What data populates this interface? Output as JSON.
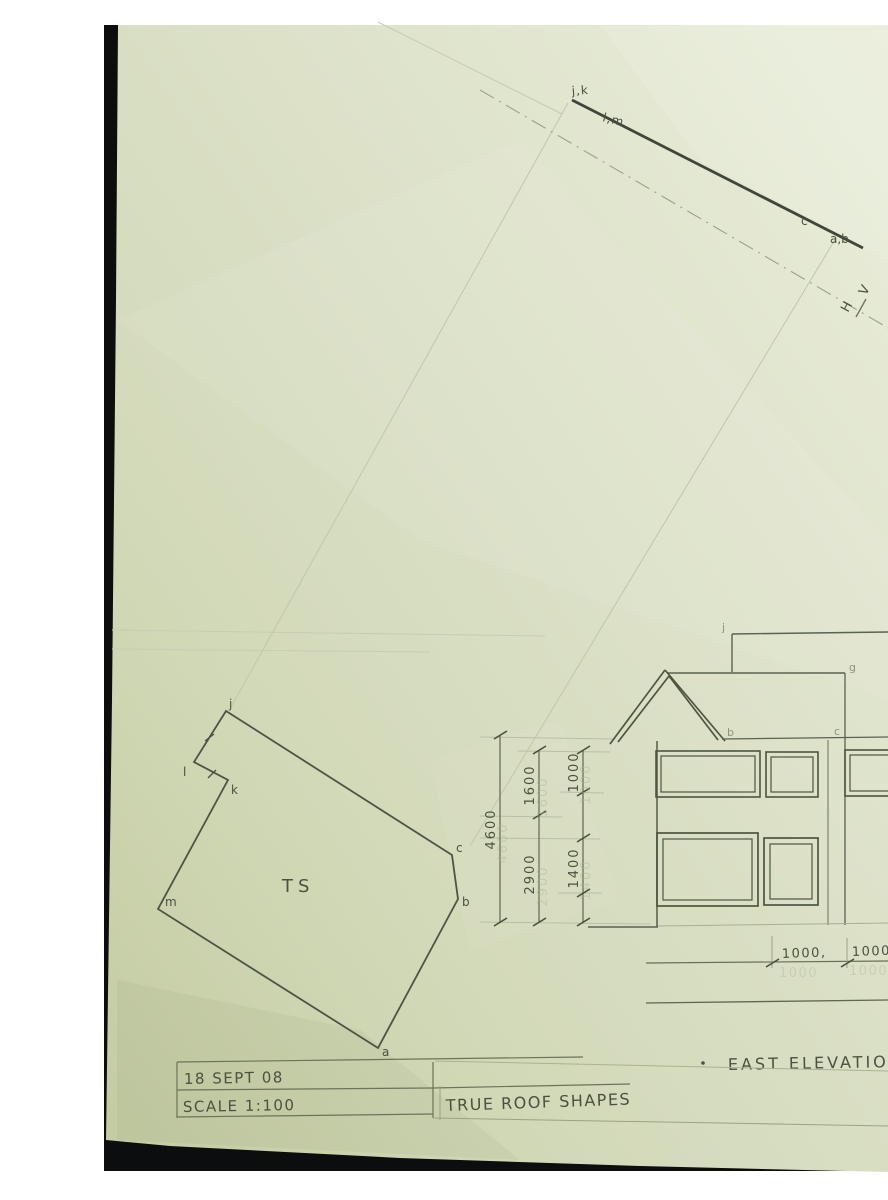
{
  "edge_view": {
    "end_top_label": "j,k",
    "mid_label": "l,m",
    "point_c_label": "c",
    "end_bottom_label": "a,b",
    "v_label": "V",
    "h_label": "H"
  },
  "true_shape": {
    "shape_label": "TS",
    "vertex_top": "j",
    "vertex_notch_left": "l",
    "vertex_notch_inner": "k",
    "vertex_left": "m",
    "vertex_bottom": "a",
    "vertex_right": "b",
    "vertex_upper_right": "c"
  },
  "dimensions": {
    "overall_height": "4600",
    "upper_segment": "1600",
    "lower_segment": "2900",
    "window_top_segment": "1000",
    "window_mid_segment": "1400",
    "spacing_first": "1000,",
    "spacing_second": "1000"
  },
  "elevation": {
    "title": "EAST ELEVATION",
    "ridge_label": "j",
    "corner_label": "g",
    "eave_right_label": "b",
    "eave_far_label": "c"
  },
  "title_block": {
    "date": "18 SEPT 08",
    "scale": "SCALE 1:100",
    "drawing_title": "TRUE ROOF SHAPES"
  }
}
